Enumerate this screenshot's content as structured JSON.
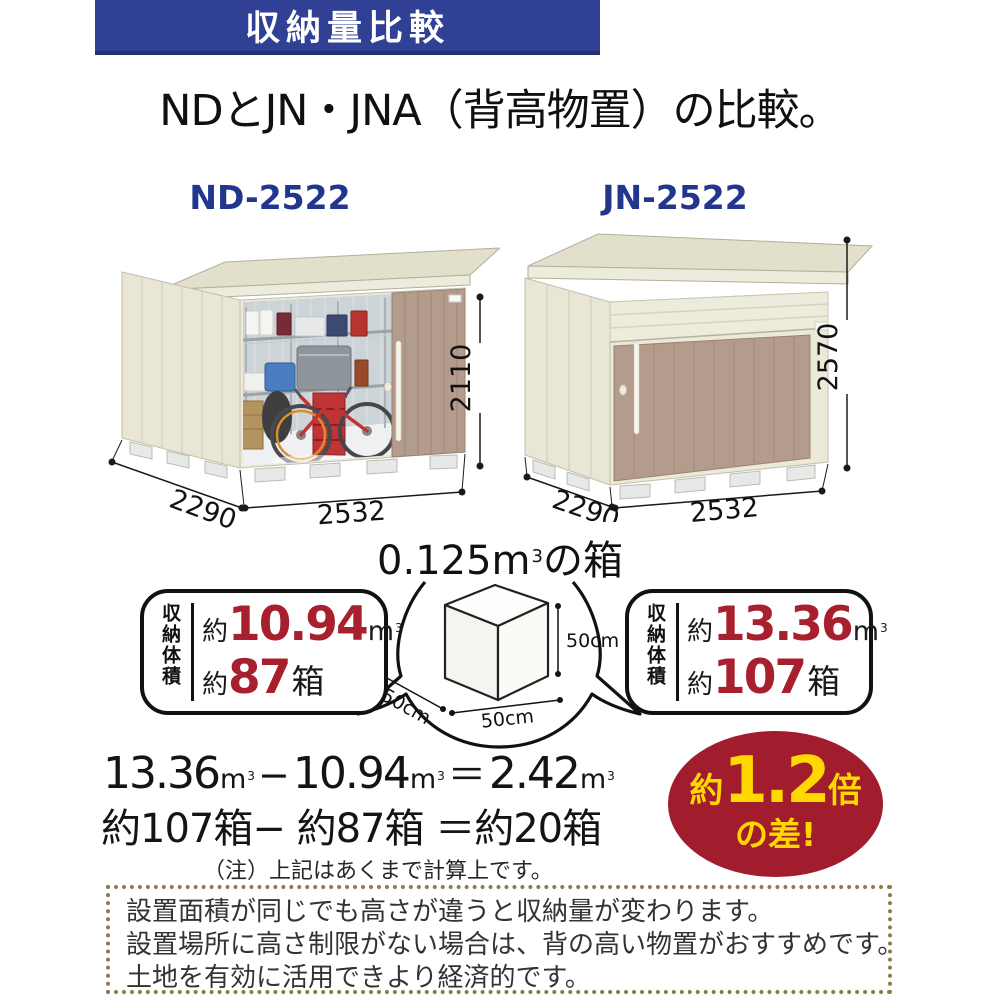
{
  "banner": {
    "title": "収納量比較"
  },
  "heading": "NDとJN・JNA（背高物置）の比較。",
  "sheds": {
    "left": {
      "model": "ND-2522",
      "width": "2532",
      "depth": "2290",
      "height": "2110"
    },
    "right": {
      "model": "JN-2522",
      "width": "2532",
      "depth": "2290",
      "height": "2570"
    }
  },
  "unit_box": {
    "value": "0.125",
    "unit": "m",
    "sup": "3",
    "suffix": "の箱",
    "dim_h": "50cm",
    "dim_w": "50cm",
    "dim_d": "50cm"
  },
  "stats": {
    "left": {
      "label": "収納体積",
      "approx": "約",
      "volume": "10.94",
      "unit": "m",
      "sup": "3",
      "approx2": "約",
      "boxes": "87",
      "boxes_unit": "箱"
    },
    "right": {
      "label": "収納体積",
      "approx": "約",
      "volume": "13.36",
      "unit": "m",
      "sup": "3",
      "approx2": "約",
      "boxes": "107",
      "boxes_unit": "箱"
    }
  },
  "calc": {
    "a": "13.36",
    "minus": "−",
    "b": "10.94",
    "eq": "＝",
    "c": "2.42",
    "unit": "m",
    "sup": "3",
    "line2": "約107箱− 約87箱 ＝約20箱",
    "note": "（注）上記はあくまで計算上です。"
  },
  "badge": {
    "approx": "約",
    "value": "1.2",
    "times": "倍",
    "line2": "の差!"
  },
  "footer": {
    "lines": [
      "設置面積が同じでも高さが違うと収納量が変わります。",
      "設置場所に高さ制限がない場合は、背の高い物置がおすすめです。",
      "土地を有効に活用できより経済的です。"
    ]
  },
  "colors": {
    "banner_bg": "#2f4095",
    "model_label": "#22368e",
    "accent_red": "#a8202e",
    "badge_bg": "#a11d2e",
    "badge_text": "#ffd800",
    "dotted_border": "#8b7b4a",
    "door_tan": "#b49c8c",
    "wall_cream": "#e9e6d6"
  }
}
